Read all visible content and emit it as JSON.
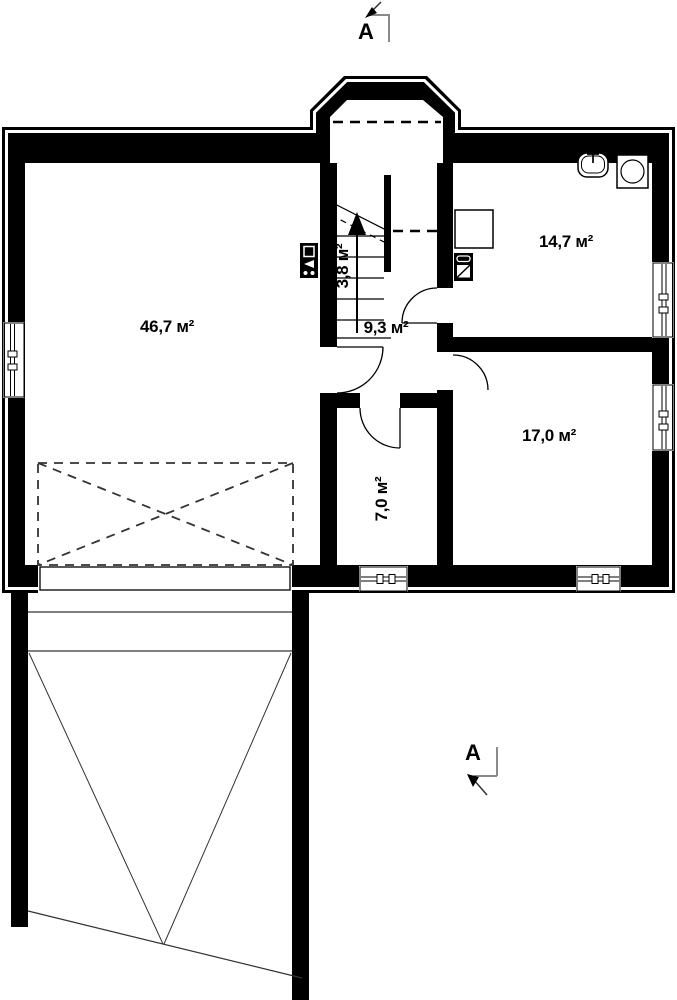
{
  "plan": {
    "section_marker_top": "A",
    "section_marker_bottom": "A",
    "rooms": [
      {
        "id": "garage",
        "area": "46,7 м²"
      },
      {
        "id": "hallway",
        "area": "9,3 м²"
      },
      {
        "id": "staircase",
        "area": "3,8 м²"
      },
      {
        "id": "utility-room",
        "area": "14,7 м²"
      },
      {
        "id": "room",
        "area": "17,0 м²"
      },
      {
        "id": "storage",
        "area": "7,0 м²"
      }
    ],
    "colors": {
      "walls": "#000000",
      "background": "#ffffff",
      "section_line": "#8a8a8a"
    }
  }
}
